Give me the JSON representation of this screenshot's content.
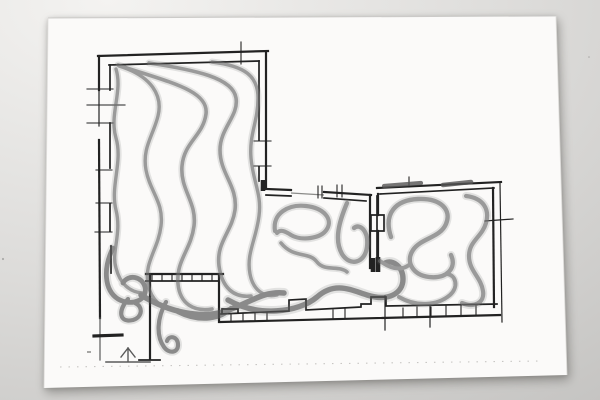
{
  "scene": {
    "subject": "photograph of a hand-drawn architectural floor plan sketch with charcoal gesture strokes on white paper",
    "text_content": ""
  },
  "colors": {
    "backdrop_light": "#f4f3f1",
    "backdrop_mid": "#dcdbd9",
    "backdrop_dark": "#c5c4c2",
    "paper": "#fbfaf9",
    "paper_edge": "#c9c8c5",
    "ink": "#222222",
    "ink_light": "#5a5a5a",
    "ink_faint": "#8a8a88",
    "charcoal": "#6f6f6f",
    "charcoal_dark": "#555555",
    "guide_dots": "#b5b3b0"
  }
}
